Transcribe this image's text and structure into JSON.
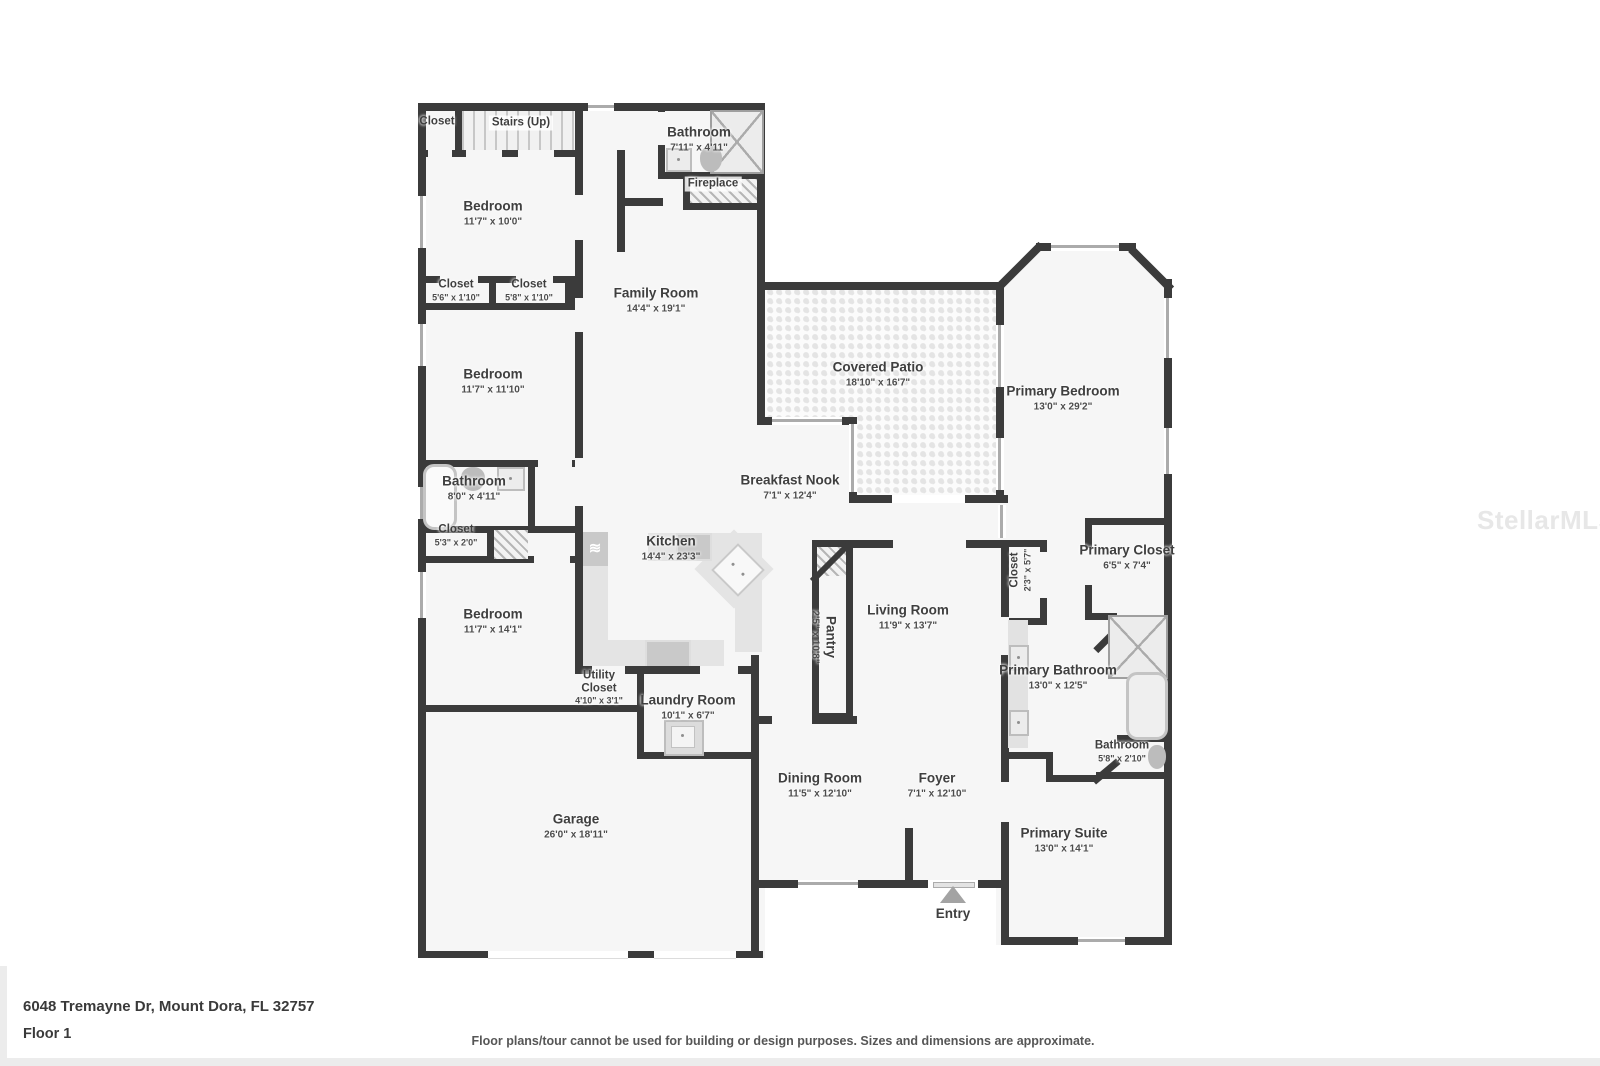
{
  "footer": {
    "address": "6048 Tremayne Dr, Mount Dora, FL 32757",
    "floor": "Floor 1",
    "disclaimer": "Floor plans/tour cannot be used for building or design purposes. Sizes and dimensions are approximate."
  },
  "watermark": "StellarMLS",
  "colors": {
    "wall": "#3b3b3b",
    "floor": "#f6f6f6",
    "label": "#3f3f3f",
    "patio_dot": "#e4e4e4"
  },
  "rooms": [
    {
      "name": "Closet",
      "dims": ""
    },
    {
      "name": "Stairs (Up)",
      "dims": ""
    },
    {
      "name": "Bathroom",
      "dims": "7'11\" x 4'11\""
    },
    {
      "name": "Fireplace",
      "dims": ""
    },
    {
      "name": "Bedroom",
      "dims": "11'7\" x 10'0\""
    },
    {
      "name": "Closet",
      "dims": "5'6\" x 1'10\""
    },
    {
      "name": "Closet",
      "dims": "5'8\" x 1'10\""
    },
    {
      "name": "Family Room",
      "dims": "14'4\" x 19'1\""
    },
    {
      "name": "Bedroom",
      "dims": "11'7\" x 11'10\""
    },
    {
      "name": "Covered Patio",
      "dims": "18'10\" x 16'7\""
    },
    {
      "name": "Primary Bedroom",
      "dims": "13'0\" x 29'2\""
    },
    {
      "name": "Bathroom",
      "dims": "8'0\" x 4'11\""
    },
    {
      "name": "Breakfast Nook",
      "dims": "7'1\" x 12'4\""
    },
    {
      "name": "Closet",
      "dims": "5'3\" x 2'0\""
    },
    {
      "name": "Kitchen",
      "dims": "14'4\" x 23'3\""
    },
    {
      "name": "Closet",
      "dims": "2'3\" x 5'7\""
    },
    {
      "name": "Primary Closet",
      "dims": "6'5\" x 7'4\""
    },
    {
      "name": "Bedroom",
      "dims": "11'7\" x 14'1\""
    },
    {
      "name": "Pantry",
      "dims": "2'5\" x 10'8\""
    },
    {
      "name": "Living Room",
      "dims": "11'9\" x 13'7\""
    },
    {
      "name": "Utility Closet",
      "dims": "4'10\" x 3'1\""
    },
    {
      "name": "Laundry Room",
      "dims": "10'1\" x 6'7\""
    },
    {
      "name": "Primary Bathroom",
      "dims": "13'0\" x 12'5\""
    },
    {
      "name": "Bathroom",
      "dims": "5'8\" x 2'10\""
    },
    {
      "name": "Dining Room",
      "dims": "11'5\" x 12'10\""
    },
    {
      "name": "Foyer",
      "dims": "7'1\" x 12'10\""
    },
    {
      "name": "Garage",
      "dims": "26'0\" x 18'11\""
    },
    {
      "name": "Primary Suite",
      "dims": "13'0\" x 14'1\""
    },
    {
      "name": "Entry",
      "dims": ""
    }
  ]
}
